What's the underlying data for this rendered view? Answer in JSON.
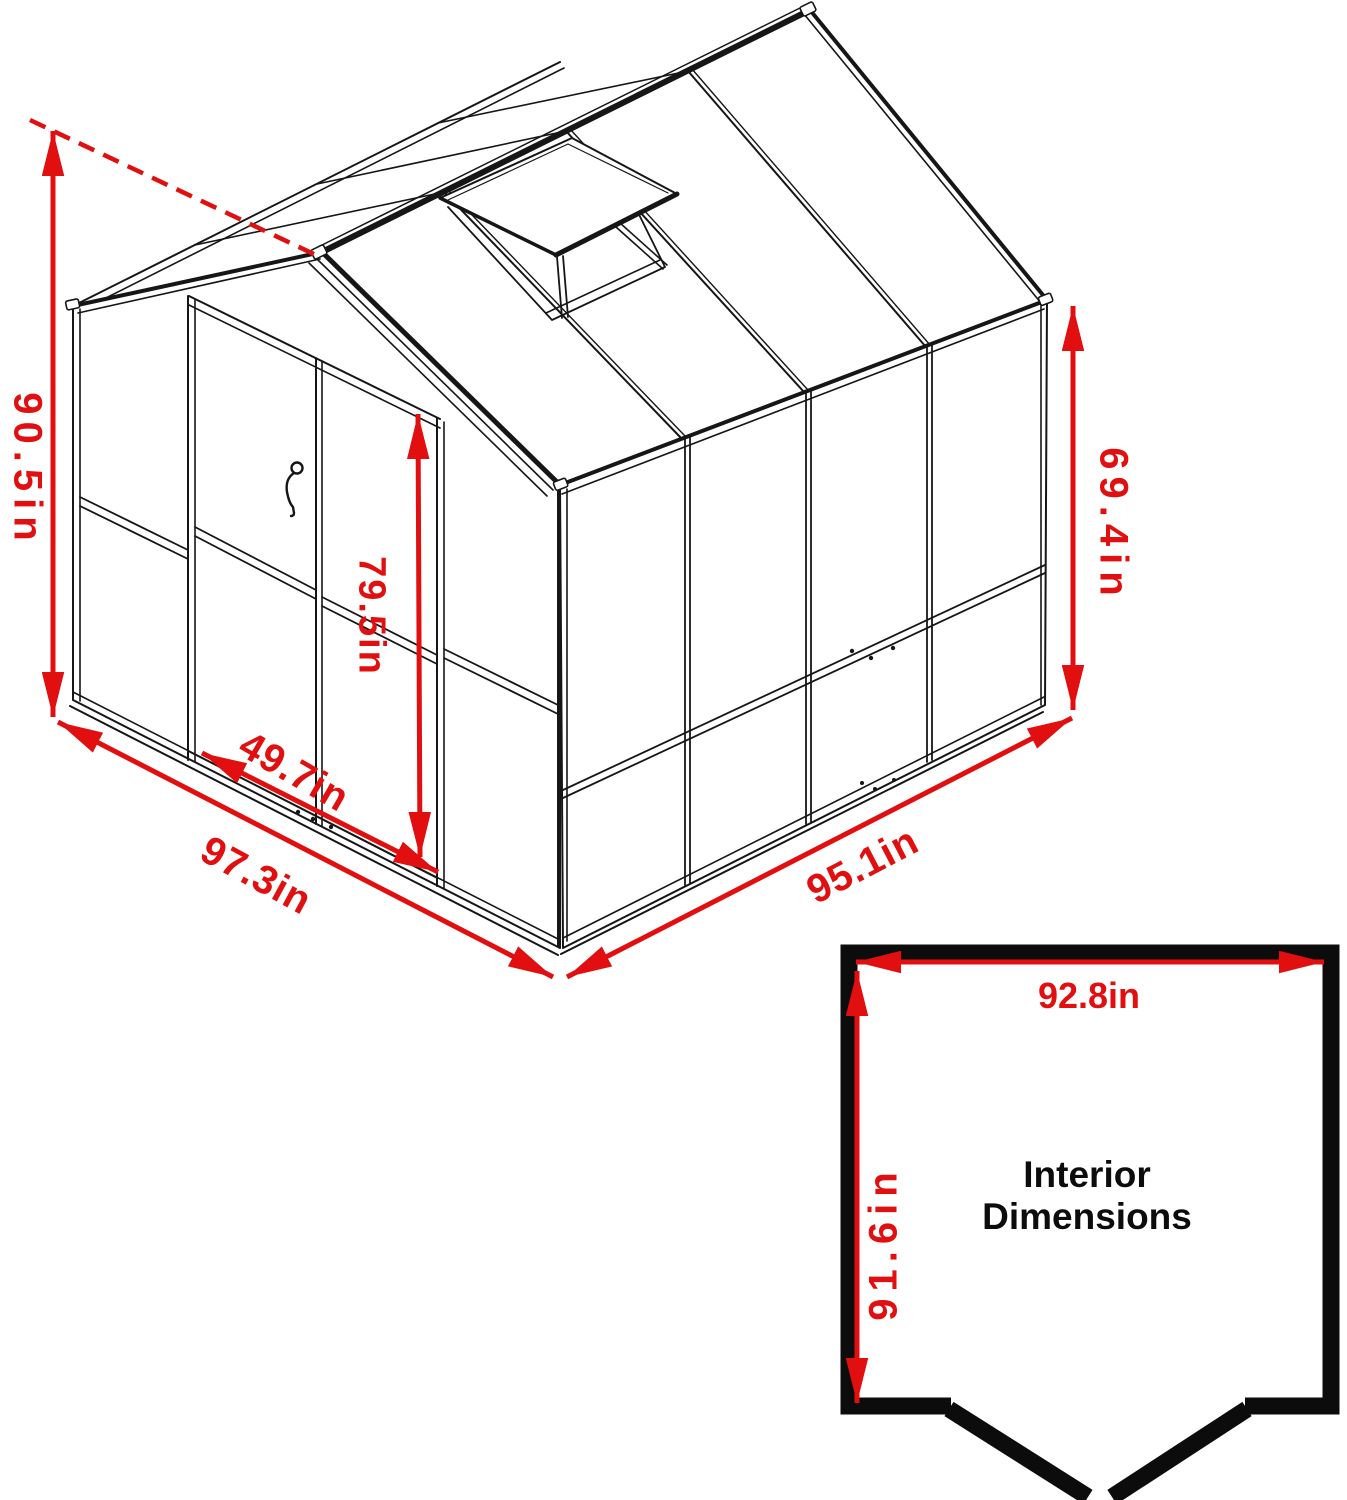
{
  "page": {
    "background": "#ffffff",
    "description": "Greenhouse isometric dimension diagram with interior floor plan"
  },
  "drawing": {
    "dimension_color": "#e10f0f",
    "line_color": "#161616",
    "labels": {
      "overall_height": "90.5in",
      "side_wall_height": "69.4in",
      "door_height": "79.5in",
      "door_width": "49.7in",
      "front_base_width": "97.3in",
      "side_base_depth": "95.1in"
    }
  },
  "interior_plan": {
    "title_line1": "Interior",
    "title_line2": "Dimensions",
    "interior_width": "92.8in",
    "interior_depth": "91.6in"
  }
}
